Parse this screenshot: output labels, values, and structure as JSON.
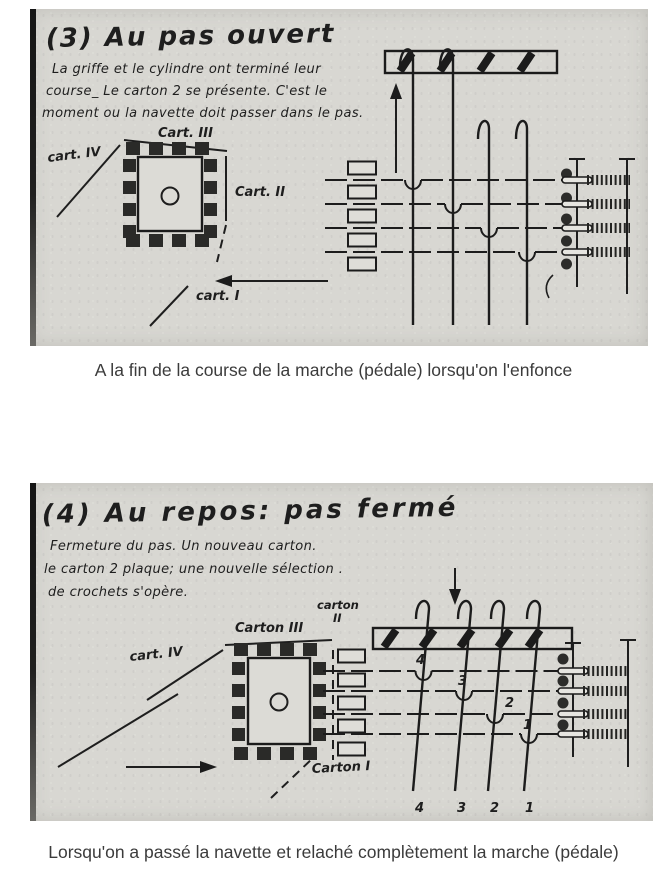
{
  "colors": {
    "ink": "#1e1e1e",
    "panel_bg": "#d8d7d2",
    "caption": "#3b3b3b"
  },
  "panel3": {
    "title": "(3) Au pas ouvert",
    "lines": [
      "La griffe et le cylindre ont terminé leur",
      "course_ Le carton 2 se présente. C'est le",
      "moment ou la navette doit passer dans le pas."
    ],
    "labels": {
      "cart3": "Cart. III",
      "cart4": "cart. IV",
      "cart2": "Cart. II",
      "cart1": "cart. I"
    }
  },
  "caption3": "A la fin de la course de la marche (pédale) lorsqu'on l'enfonce",
  "panel4": {
    "title": "(4) Au repos: pas fermé",
    "lines": [
      "Fermeture du pas. Un nouveau carton.",
      "le carton 2 plaque; une nouvelle sélection .",
      "de crochets s'opère."
    ],
    "labels": {
      "carton_word": "carton",
      "carton_num": "II",
      "carton3": "Carton III",
      "cart4": "cart. IV",
      "carton1": "Carton I"
    },
    "hook_numbers": [
      "4",
      "3",
      "2",
      "1"
    ],
    "tail_numbers": [
      "4",
      "3",
      "2",
      "1"
    ]
  },
  "caption4": "Lorsqu'on a passé la navette et relaché complètement la marche (pédale)"
}
